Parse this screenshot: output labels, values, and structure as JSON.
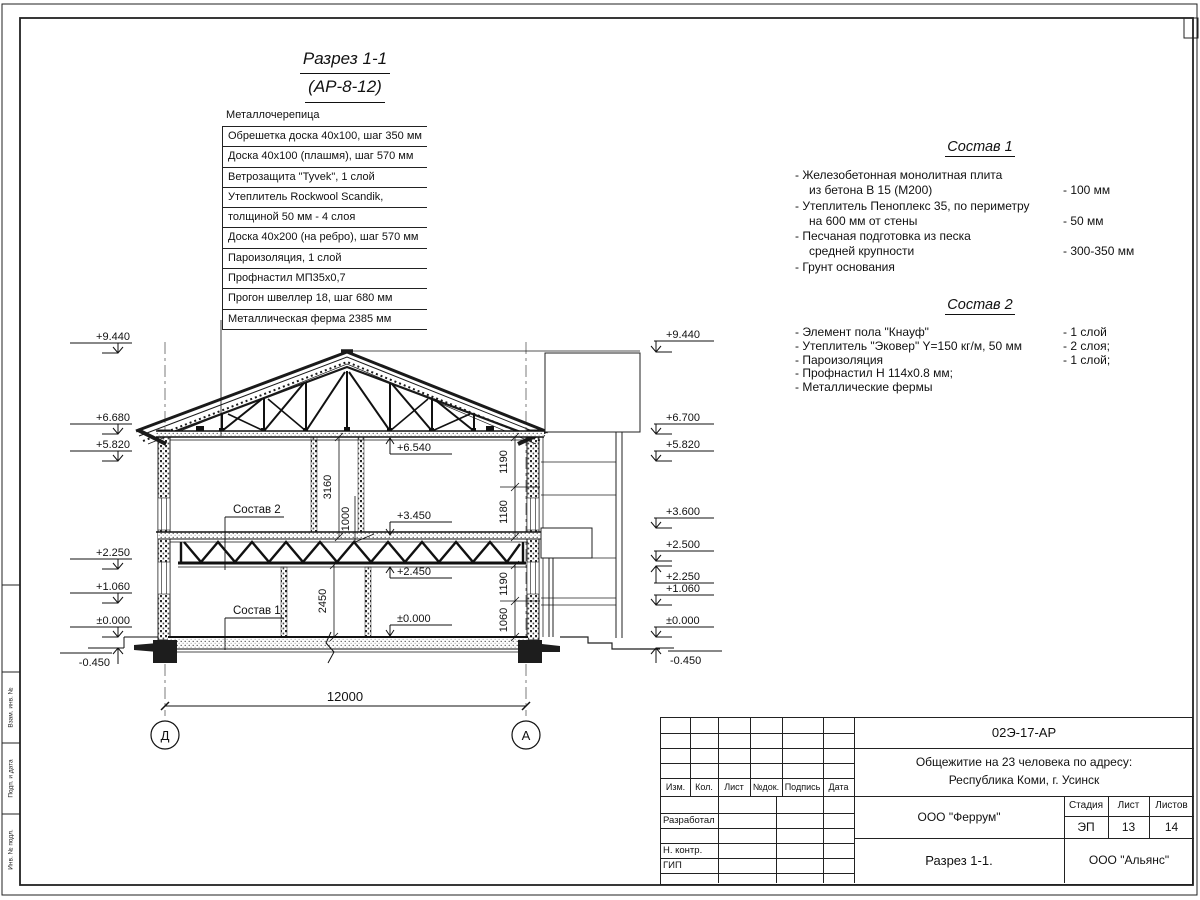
{
  "title": {
    "line1": "Разрез 1-1",
    "line2": "(АР-8-12)"
  },
  "roof_layers": {
    "label": "Металлочерепица",
    "rows": [
      "Обрешетка доска 40х100, шаг 350 мм",
      "Доска 40х100 (плашмя), шаг 570 мм",
      "Ветрозащита \"Tyvek\", 1 слой",
      "Утеплитель Rockwool Scandik,",
      "толщиной 50 мм - 4 слоя",
      "Доска 40х200 (на ребро), шаг 570 мм",
      "Пароизоляция, 1 слой",
      "Профнастил МП35х0,7",
      "Прогон швеллер 18, шаг 680 мм",
      "Металлическая ферма 2385 мм"
    ]
  },
  "sostav1": {
    "title": "Состав 1",
    "items": [
      {
        "t": "- Железобетонная  монолитная плита",
        "v": ""
      },
      {
        "t": "из бетона В 15 (М200)",
        "v": "- 100 мм"
      },
      {
        "t": "- Утеплитель Пеноплекс 35, по периметру",
        "v": ""
      },
      {
        "t": "на 600 мм от стены",
        "v": "- 50 мм"
      },
      {
        "t": "- Песчаная подготовка из песка",
        "v": ""
      },
      {
        "t": "средней крупности",
        "v": "- 300-350 мм"
      },
      {
        "t": "- Грунт основания",
        "v": ""
      }
    ]
  },
  "sostav2": {
    "title": "Состав 2",
    "items": [
      {
        "t": "- Элемент пола \"Кнауф\"",
        "v": "- 1 слой"
      },
      {
        "t": "- Утеплитель \"Эковер\" Y=150 кг/м, 50 мм",
        "v": "- 2 слоя;"
      },
      {
        "t": "- Пароизоляция",
        "v": "- 1 слой;"
      },
      {
        "t": "- Профнастил Н 114х0.8 мм;",
        "v": ""
      },
      {
        "t": "- Металлические фермы",
        "v": ""
      }
    ]
  },
  "levels_left": [
    "+9.440",
    "+6.680",
    "+5.820",
    "+2.250",
    "+1.060",
    "±0.000",
    "-0.450"
  ],
  "levels_right": [
    "+9.440",
    "+6.700",
    "+5.820",
    "+3.600",
    "+2.500",
    "+2.250",
    "+1.060",
    "±0.000",
    "-0.450"
  ],
  "levels_inner": [
    "+6.540",
    "+3.450",
    "+2.450",
    "±0.000"
  ],
  "dims": {
    "span": "12000",
    "h1": "3160",
    "h2": "1000",
    "h3": "2450",
    "r1": "1190",
    "r2": "1180",
    "r3": "1190",
    "r4": "1060"
  },
  "callouts": {
    "c1": "Состав 1",
    "c2": "Состав 2"
  },
  "axes": {
    "left": "Д",
    "right": "А"
  },
  "frame_strip": {
    "s1": "Взам. инв. №",
    "s2": "Подп. и дата",
    "s3": "Инв. № подл."
  },
  "titleblock": {
    "doc_number": "02Э-17-АР",
    "project_line1": "Общежитие на 23 человека по адресу:",
    "project_line2": "Республика Коми, г. Усинск",
    "headers": {
      "izm": "Изм.",
      "kol": "Кол.",
      "list": "Лист",
      "ndok": "№док.",
      "podpis": "Подпись",
      "data": "Дата"
    },
    "roles": {
      "razrabotal": "Разработал",
      "nkontr": "Н. контр.",
      "gip": "ГИП"
    },
    "org1": "ООО \"Феррум\"",
    "stage_label": "Стадия",
    "sheet_label": "Лист",
    "sheets_label": "Листов",
    "stage": "ЭП",
    "sheet_no": "13",
    "sheets_total": "14",
    "drawing_name": "Разрез 1-1.",
    "org2": "ООО \"Альянс\""
  }
}
